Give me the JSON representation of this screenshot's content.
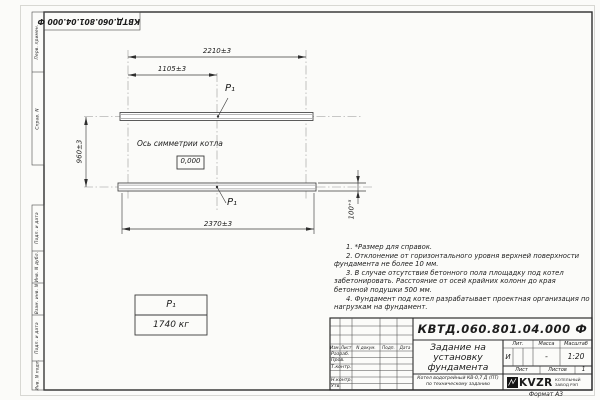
{
  "sheet": {
    "corner_doc_number": "КВТД.060.801.04.000 Ф",
    "format_label": "Формат А3"
  },
  "margin": {
    "top": [
      "Перв. примен.",
      "Справ. N"
    ],
    "bottom": [
      "Подп. и дата",
      "Инв. N дубл.",
      "Взам. инв. N",
      "Подп. и дата",
      "Инв. N подл."
    ]
  },
  "drawing": {
    "dim_top": "2210±3",
    "dim_half": "1105±3",
    "dim_bottom": "2370±3",
    "dim_left": "960±3",
    "dim_right": "100⁺⁵",
    "axis_label": "Ось симметрии котла",
    "level_mark": "0,000",
    "load_point_top": "P₁",
    "load_point_bottom": "P₁",
    "mass_table": {
      "header": "P₁",
      "value": "1740 кг"
    }
  },
  "notes": [
    "1. *Размер для справок.",
    "2. Отклонение от горизонтального уровня верхней поверхности фундамента не более 10 мм.",
    "3. В случае отсутствия бетонного пола площадку под котел забетонировать. Расстояние от осей крайних колонн до края бетонной подушки 500 мм.",
    "4. Фундамент под котел разрабатывает проектная организация по нагрузкам на фундамент."
  ],
  "title_block": {
    "doc_number": "КВТД.060.801.04.000  Ф",
    "title_lines": [
      "Задание на",
      "установку",
      "фундамента"
    ],
    "subtitle_lines": [
      "Котел водогрейный КВ-0,7 Д (ПТ)",
      "по техническому заданию"
    ],
    "header_row": [
      "Изм.",
      "Лист",
      "N докум.",
      "Подп.",
      "Дата"
    ],
    "signature_rows": [
      "Разраб.",
      "Пров.",
      "Т.контр.",
      "Н.контр.",
      "Утв."
    ],
    "lit_header": "Лит.",
    "lit_value": "И",
    "mass_header": "Масса",
    "mass_value": "-",
    "scale_header": "Масштаб",
    "scale_value": "1:20",
    "sheet_label": "Лист",
    "sheets_label": "Листов",
    "sheets_value": "1",
    "logo_text": "KVZR",
    "logo_caption_lines": [
      "КОТЕЛЬНЫЙ",
      "ЗАВОД РЭП"
    ]
  }
}
